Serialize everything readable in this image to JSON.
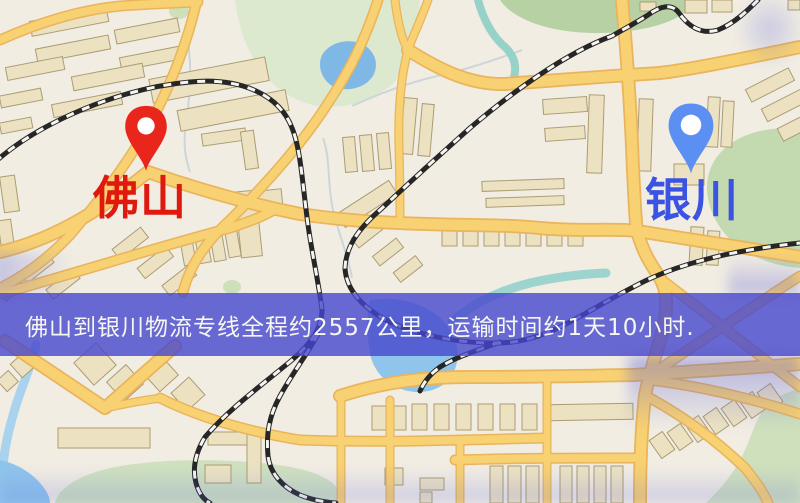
{
  "map": {
    "type": "stylized-road-map",
    "colors": {
      "background": "#f1ede3",
      "road_fill": "#f8d172",
      "road_casing": "#e9b45c",
      "building": "#ece2c2",
      "park_green": "#c3dab0",
      "water_blue": "#7fb7e5",
      "railway_dark": "#262626"
    }
  },
  "markers": [
    {
      "id": "origin-city",
      "label": "佛山",
      "pin_color": "#e8261b",
      "label_color": "#e0190e",
      "pin_style": "red-map-pin"
    },
    {
      "id": "destination-city",
      "label": "银川",
      "pin_color": "#5b8ff2",
      "label_color": "#3b53e2",
      "pin_style": "blue-map-pin"
    }
  ],
  "banner": {
    "text": "佛山到银川物流专线全程约2557公里，运输时间约1天10小时.",
    "background_color": "#4646cd",
    "text_color": "#f6f7f0"
  }
}
